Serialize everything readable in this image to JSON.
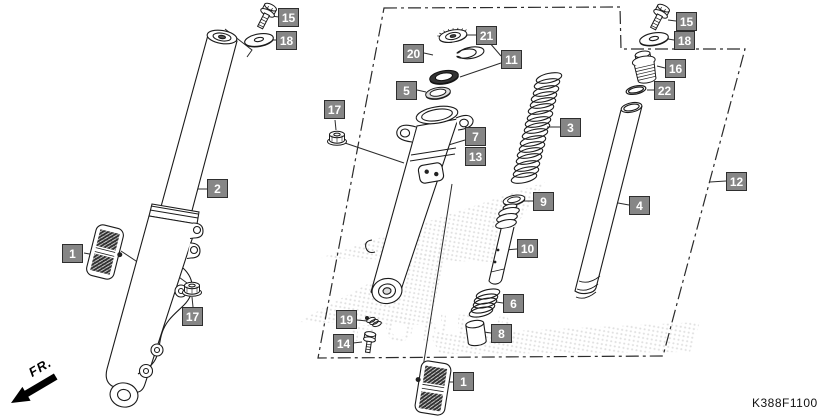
{
  "diagram": {
    "title_code": "K388F1100",
    "fr_label": "FR.",
    "watermark": "HONDA",
    "callouts": [
      "15",
      "18",
      "2",
      "1",
      "17",
      "17",
      "20",
      "21",
      "11",
      "5",
      "7",
      "13",
      "3",
      "9",
      "10",
      "6",
      "8",
      "1",
      "19",
      "14",
      "4",
      "16",
      "22",
      "15",
      "18",
      "12"
    ]
  }
}
